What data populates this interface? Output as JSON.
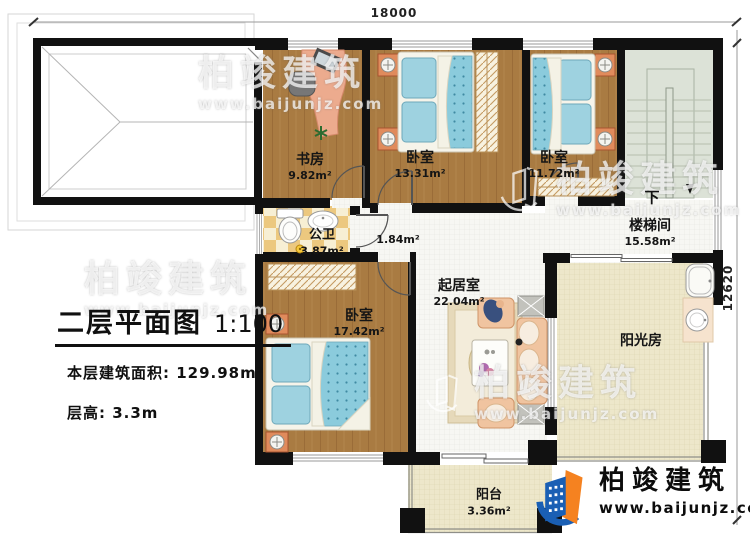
{
  "dimensions": {
    "top": "18000",
    "right": "12620"
  },
  "title_block": {
    "title": "二层平面图",
    "scale": "1:100",
    "floor_area": "本层建筑面积: 129.98m²",
    "floor_height": "层高: 3.3m"
  },
  "rooms": {
    "study": {
      "name": "书房",
      "area": "9.82m²"
    },
    "bedroom1": {
      "name": "卧室",
      "area": "13.31m²"
    },
    "bedroom2": {
      "name": "卧室",
      "area": "11.72m²"
    },
    "stairwell": {
      "name": "楼梯间",
      "area": "15.58m²",
      "direction": "下"
    },
    "bathroom": {
      "name": "公卫",
      "area": "3.87m²"
    },
    "hallway": {
      "area": "1.84m²"
    },
    "living": {
      "name": "起居室",
      "area": "22.04m²"
    },
    "bedroom3": {
      "name": "卧室",
      "area": "17.42m²"
    },
    "sunroom": {
      "name": "阳光房"
    },
    "balcony": {
      "name": "阳台",
      "area": "3.36m²"
    }
  },
  "watermark": {
    "text": "柏竣建筑",
    "url": "www.baijunjz.com"
  },
  "logo": {
    "name": "柏竣建筑",
    "url": "www.baijunjz.com"
  },
  "colors": {
    "wall": "#111111",
    "wood_floor": "#a97b42",
    "living_floor": "#f7f7f3",
    "tile_cream": "#ede7ca",
    "bathroom_tile": "#ecc87f",
    "stairs": "#dce2d7",
    "bed_blue": "#9ed2e0",
    "sofa_peach": "#f0c4a0",
    "logo_blue": "#1a5fb4",
    "logo_orange": "#f58220"
  }
}
